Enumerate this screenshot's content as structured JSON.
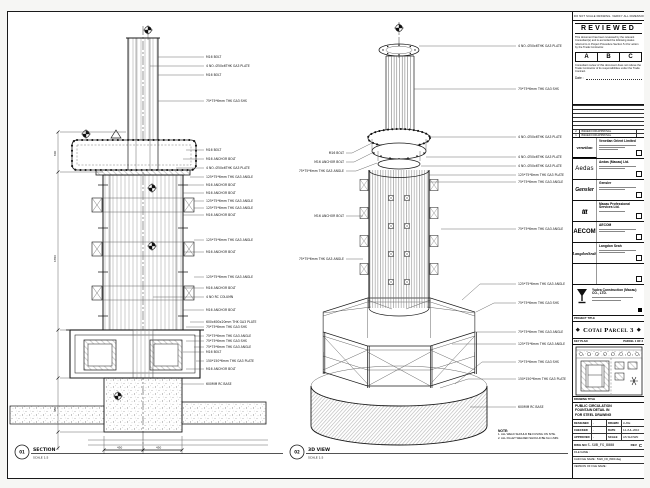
{
  "sheet": {
    "top_strip": "DO NOT SCALE DRAWING. VERIFY ALL DIMENSIONS ON SITE.",
    "notes_heading": "NOTE:",
    "notes": [
      "1. ALL WELD SHOULD BE FUSING ON SITE.",
      "2. ALL FILLET WELDED SHOULD BE 6mm MIN."
    ]
  },
  "stamp": {
    "title": "REVIEWED",
    "p1": "This document has been reviewed by the relevant Consultant(s) and is accorded the following status referred to in Project Procedure Section 5.4 for action by the Trade Contractor.",
    "grades": [
      "A",
      "B",
      "C"
    ],
    "p2": "Consultant review of this document does not relieve the Trade Contractor of its responsibilities under the Trade Contract.",
    "date_label": "Date :"
  },
  "revisions": [
    {
      "rev": "2",
      "desc": "ISSUED FOR APPROVAL"
    },
    {
      "rev": "1",
      "desc": "ISSUED FOR APPROVAL"
    }
  ],
  "consultants": [
    {
      "logo": "venetian",
      "name": "Venetian Orient Limited"
    },
    {
      "logo": "Aedas",
      "name": "Aedas (Macau) Ltd."
    },
    {
      "logo": "Gensler",
      "name": "Gensler"
    },
    {
      "logo": "ttt",
      "name": "Macau Professional Services Ltd."
    },
    {
      "logo": "AECOM",
      "name": "AECOM"
    },
    {
      "logo": "LangdonSeah",
      "name": "Langdon Seah"
    },
    {
      "logo": "",
      "name": ""
    }
  ],
  "contractor": {
    "name": "Yudea Construction (Macau) CO., LTD."
  },
  "project": {
    "label": "PROJECT TITLE",
    "title": "Cotai Parcel 3"
  },
  "key_plan": {
    "label": "KEY PLAN",
    "right": "PARCEL 1 OF 3"
  },
  "title_block": {
    "label": "DRAWING TITLE",
    "lines": [
      "PUBLIC CIRCULATION",
      "FOUNTAIN DETAIL IN",
      "FOR STEEL DRAWING"
    ],
    "rows": [
      {
        "l1": "DESIGNED",
        "v1": "-",
        "l2": "DRAWN",
        "v2": "LUKE"
      },
      {
        "l1": "CHECKED",
        "v1": "-",
        "l2": "DATE",
        "v2": "14-JUL-2010"
      },
      {
        "l1": "APPROVED",
        "v1": "-",
        "l2": "SCALE",
        "v2": "AS SHOWN"
      }
    ],
    "dwg_label": "DWG NO",
    "dwg_no": "S-SUB_FG_8000",
    "rev_label": "REV",
    "rev": "C",
    "files": [
      "FILE NAME :",
      "CAD FILE NAME : 5320_FD_8000.dwg",
      "VERSION OF FILE NAME :"
    ]
  },
  "views": {
    "section": {
      "num": "01",
      "title": "SECTION",
      "scale": "SCALE 1:5",
      "dims": [
        "600",
        "1350",
        "450"
      ],
      "bottom_dims": [
        "450",
        "450"
      ],
      "callouts": [
        "M16 BOLT",
        "4 NO. Ø50x6THK GA3 PLATE",
        "M16 BOLT",
        "75*75*6mm THK GA3 SHS",
        "M16 BOLT",
        "M16 ANCHOR BOLT",
        "4 NO. Ø50x6THK GA3 PLATE",
        "125*75*6mm THK GA3 ANGLE",
        "M16 ANCHOR BOLT",
        "M16 ANCHOR BOLT",
        "125*75*6mm THK GA3 ANGLE",
        "125*75*6mm THK GA3 ANGLE",
        "M16 ANCHOR BOLT",
        "125*75*6mm THK GA3 ANGLE",
        "M16 ANCHOR BOLT",
        "125*75*6mm THK GA3 ANGLE",
        "M16 ANCHOR BOLT",
        "4 NO RC COLUMN",
        "M16 ANCHOR BOLT",
        "600x600x20mm THK GA3 PLATE",
        "75*75*6mm THK GA3 SHS",
        "75*75*6mm THK GA3 ANGLE",
        "75*75*6mm THK GA3 SHS",
        "75*75*6mm THK GA3 ANGLE",
        "M16 BOLT",
        "150*150*6mm THK GA3 PLATE",
        "M16 ANCHOR BOLT",
        "600MM RC BASE"
      ]
    },
    "iso": {
      "num": "02",
      "title": "3D VIEW",
      "scale": "SCALE 1:5",
      "callouts_right": [
        "4 NO. Ø50x6THK GA3 PLATE",
        "75*75*6mm THK GA3 SHS",
        "4 NO. Ø50x6THK GA3 PLATE",
        "4 NO. Ø50x6THK GA3 PLATE",
        "4 NO. Ø50x6THK GA3 PLATE",
        "125*75*8mm THK GA3 PLATE",
        "75*75*6mm THK GA3 ANGLE",
        "75*75*6mm THK GA3 ANGLE",
        "125*75*6mm THK GA3 ANGLE",
        "75*75*6mm THK GA3 SHS",
        "75*75*6mm THK GA3 ANGLE",
        "125*75*6mm THK GA3 ANGLE",
        "75*75*6mm THK GA3 SHS",
        "150*150*6mm THK GA3 PLATE",
        "600MM RC BASE"
      ],
      "callouts_left": [
        "M16 BOLT",
        "M16 ANCHOR BOLT",
        "75*75*6mm THK GA3 ANGLE",
        "M16 ANCHOR BOLT",
        "75*75*6mm THK GA3 ANGLE"
      ]
    }
  }
}
